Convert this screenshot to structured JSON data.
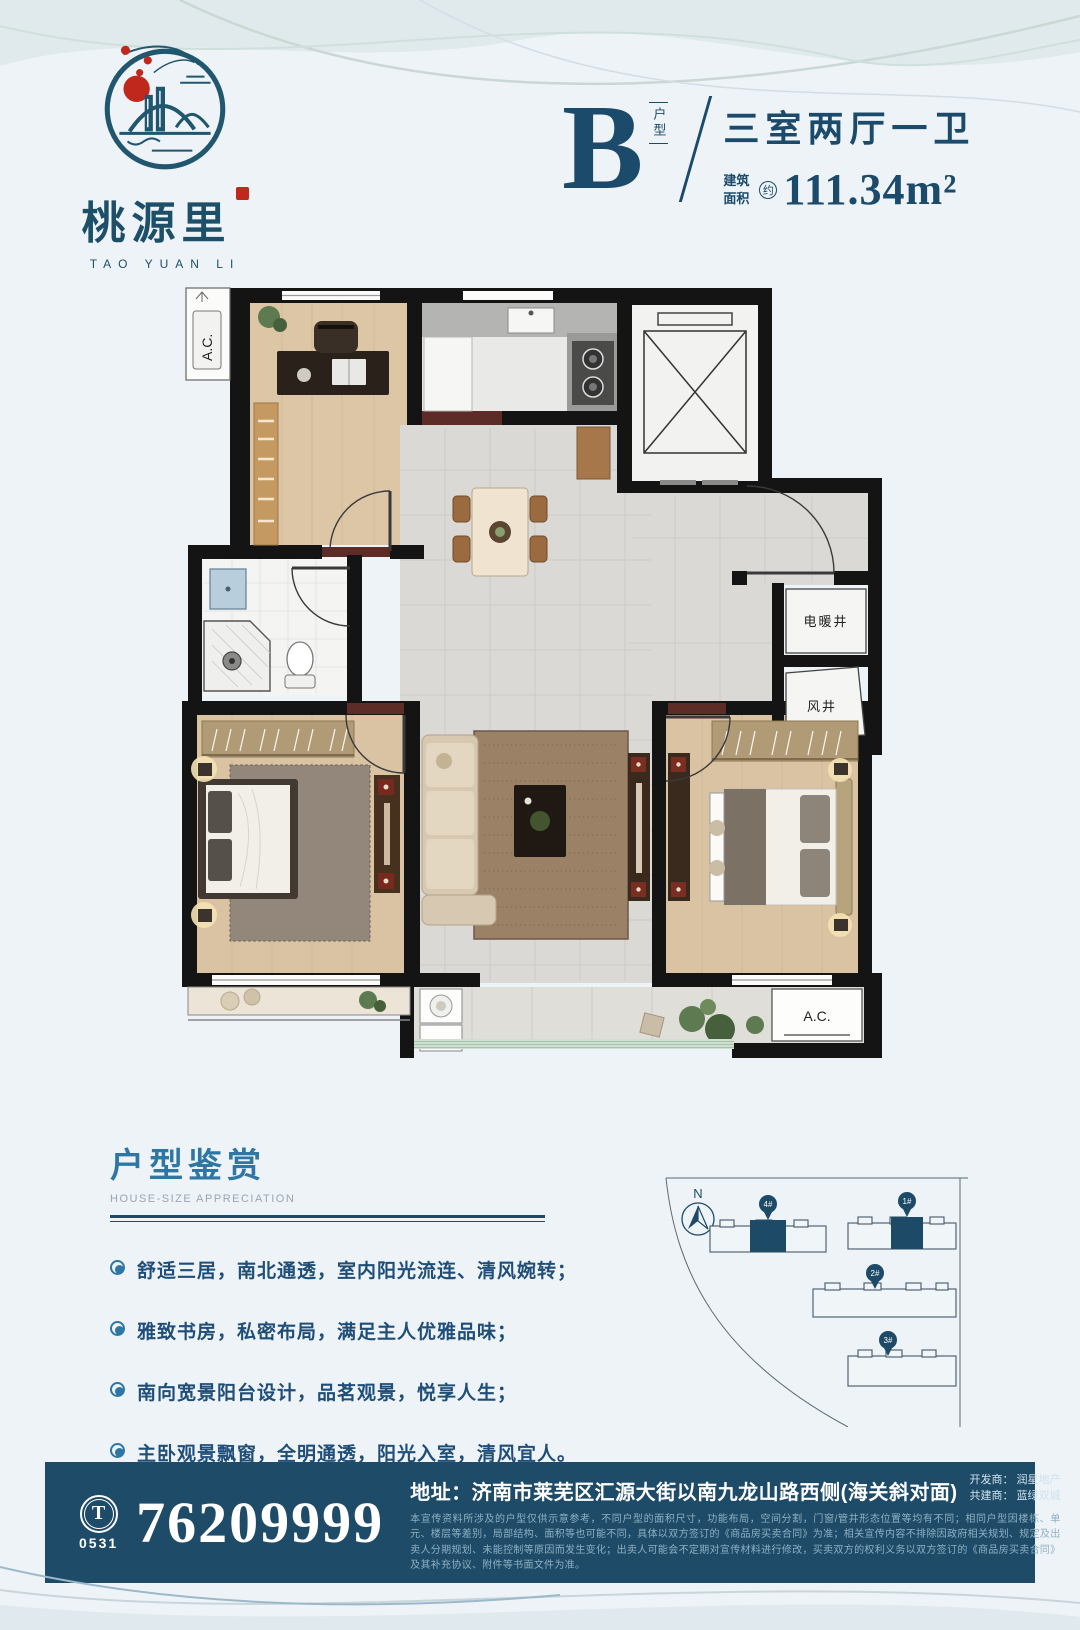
{
  "brand": {
    "name_cn": "桃源里",
    "name_en": "TAO YUAN LI",
    "logo_icon": "landscape-circle-logo",
    "accent_red": "#c0271d",
    "accent_blue": "#1d4f68"
  },
  "unit": {
    "letter": "B",
    "type_label": "户型",
    "layout": "三室两厅一卫",
    "area_label_1": "建筑",
    "area_label_2": "面积",
    "area_approx": "约",
    "area_value": "111.34m²"
  },
  "floorplan": {
    "labels": {
      "ac_top": "A.C.",
      "heating_shaft": "电暖井",
      "air_shaft": "风井",
      "ac_bottom": "A.C."
    }
  },
  "features": {
    "title_cn": "户型鉴赏",
    "title_en": "HOUSE-SIZE APPRECIATION",
    "items": [
      "舒适三居，南北通透，室内阳光流连、清风婉转；",
      "雅致书房，私密布局，满足主人优雅品味；",
      "南向宽景阳台设计，品茗观景，悦享人生；",
      "主卧观景飘窗，全明通透，阳光入室，清风宜人。"
    ]
  },
  "siteplan": {
    "north_label": "N",
    "buildings": [
      {
        "id": "4#"
      },
      {
        "id": "1#"
      },
      {
        "id": "2#"
      },
      {
        "id": "3#"
      }
    ],
    "pin_color": "#1d4a66"
  },
  "footer": {
    "phone_icon_letter": "T",
    "area_code": "0531",
    "phone": "76209999",
    "address_label": "地址：",
    "address": "济南市莱芜区汇源大街以南九龙山路西侧(海关斜对面)",
    "developer_line": "开发商： 润星地产",
    "co_builder_line": "共建商： 蓝绿双城",
    "disclaimer": "本宣传资料所涉及的户型仅供示意参考，不同户型的面积尺寸，功能布局，空间分割，门窗/管井形态位置等均有不同；相同户型因楼栋、单元、楼层等差别，局部结构、面积等也可能不同，具体以双方签订的《商品房买卖合同》为准；相关宣传内容不排除因政府相关规划、规定及出卖人分期规划、未能控制等原因而发生变化；出卖人可能会不定期对宣传材料进行修改，买卖双方的权利义务以双方签订的《商品房买卖合同》及其补充协议、附件等书面文件为准。",
    "bar_color": "#1e4b68"
  }
}
